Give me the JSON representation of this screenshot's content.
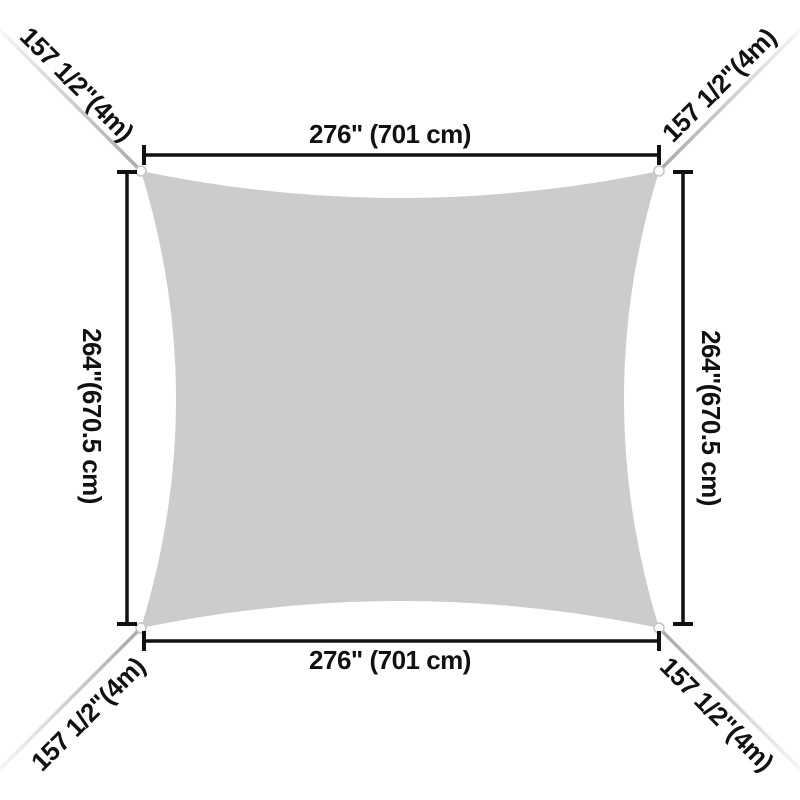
{
  "colors": {
    "page_bg": "#ffffff",
    "sail_fill": "#cccccc",
    "line_color": "#111111",
    "rope_start": "#a8a8a8",
    "rope_end": "#f8f8f8",
    "dot_fill": "#ffffff",
    "dot_stroke": "#c4c4c4"
  },
  "dimensions": {
    "top_width": "276\" (701 cm)",
    "bottom_width": "276\" (701 cm)",
    "left_height": "264\"(670.5 cm)",
    "right_height": "264\"(670.5 cm)",
    "rope_top_left": "157 1/2\"(4m)",
    "rope_top_right": "157 1/2\"(4m)",
    "rope_bottom_left": "157 1/2\"(4m)",
    "rope_bottom_right": "157 1/2\"(4m)"
  }
}
